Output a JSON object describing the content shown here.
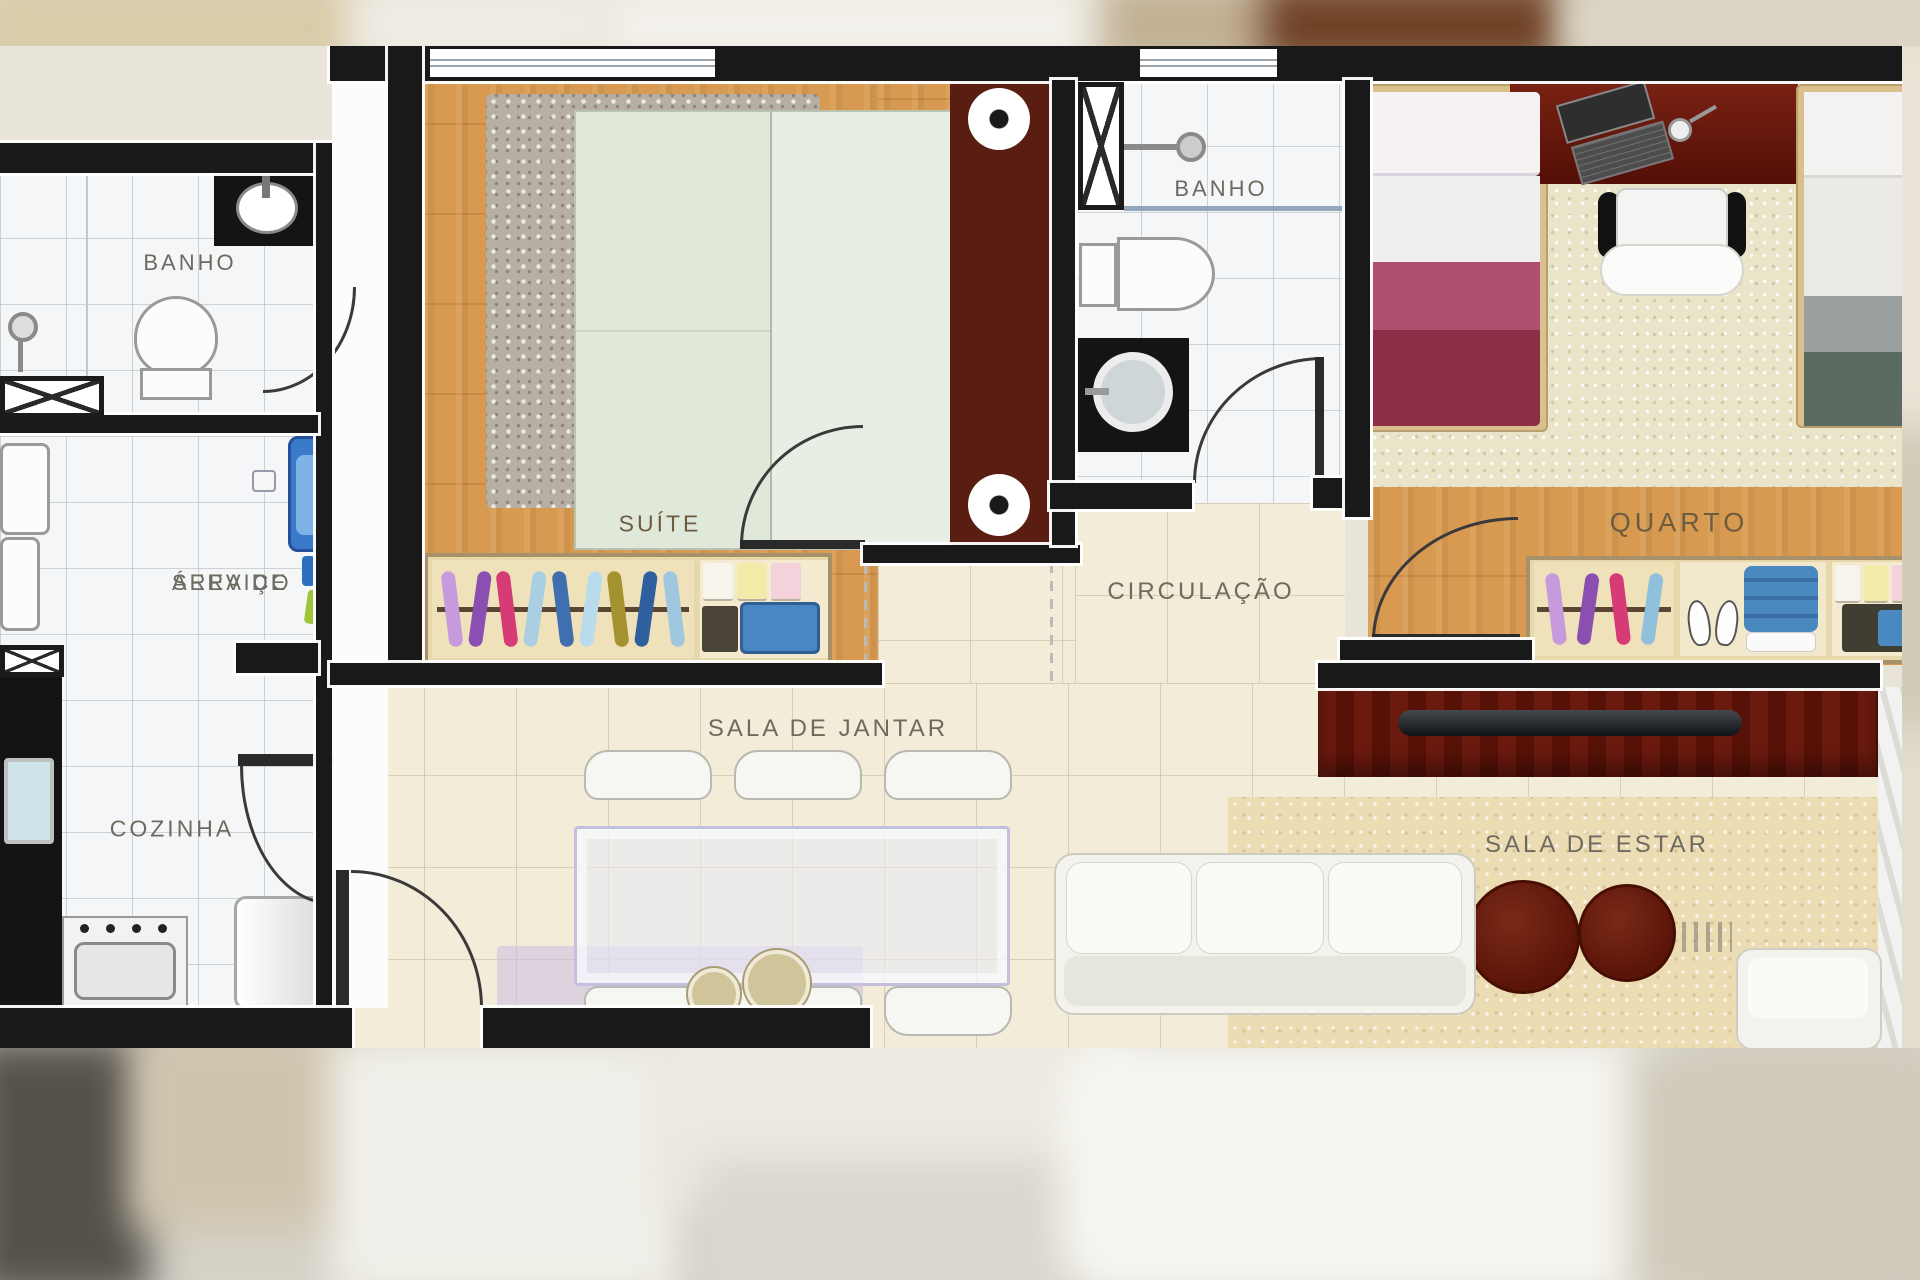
{
  "title": "Planta humanizada de apartamento (2 quartos)",
  "rooms": {
    "banho_1": "BANHO",
    "area_servico_l1": "ÁREA DE",
    "area_servico_l2": "SERVIÇO",
    "cozinha": "COZINHA",
    "suite": "SUÍTE",
    "banho_2": "BANHO",
    "circulacao": "CIRCULAÇÃO",
    "quarto": "QUARTO",
    "sala_jantar": "SALA DE JANTAR",
    "sala_estar": "SALA DE ESTAR"
  },
  "colors": {
    "wall": "#191919",
    "wood_floor": "#d89a50",
    "tile_white": "#f4f6f7",
    "tile_cream": "#f3ecd9",
    "carpet_beige": "#eae4c9",
    "rug_gray": "#b7afa3",
    "rug_tan": "#ecdcb4",
    "bed_suite_green": "#e0e8d9",
    "headboard_maroon": "#5a1d12",
    "bed1_blanket_maroon": "#8c2f46",
    "bed1_blanket_pink": "#b0506e",
    "bed2_blanket_slate": "#5c6b62",
    "furniture_darkwood": "#6b1a0e",
    "laundry_tub_blue": "#3b79c9",
    "dining_glass": "#e8e8f4",
    "lilac_rug": "#c8c0e4"
  },
  "closets": {
    "suite_clothes": [
      "#c79ade",
      "#8a4fb0",
      "#d63b76",
      "#aacfe2",
      "#3f6fae",
      "#b8dcec",
      "#a3922f",
      "#2f5f9e",
      "#9fc8e0"
    ],
    "quarto_clothes": [
      "#c79ade",
      "#8a4fb0",
      "#d63b76",
      "#8fc0dc"
    ],
    "stack_colors": [
      "#f7f4ec",
      "#f2eaa8",
      "#f4d2dc"
    ]
  }
}
